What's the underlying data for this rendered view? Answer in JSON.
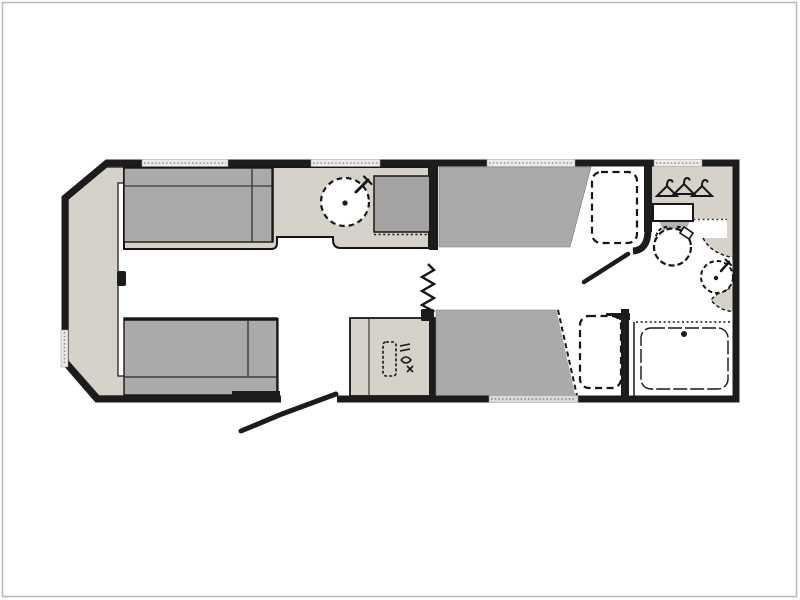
{
  "image": {
    "kind": "floor-plan-drawing",
    "visible_text": ""
  },
  "colors": {
    "page_bg": "#ffffff",
    "border": "#b9b9b9",
    "wall": "#1c1c1c",
    "furniture_light": "#d6d2c9",
    "furniture_dark": "#acaaa8",
    "hob": "#a6a4a2",
    "cistern_neck": "#b5b3b0",
    "window_fill": "#eceae8",
    "window_tick": "#8f8f8f",
    "fixture_line": "#161616",
    "thin_line": "#3a3a3a"
  },
  "legend": {
    "plan": "caravan floor plan",
    "shell": "caravan outer wall",
    "front_chest": "front chest shelf",
    "offside_sofa": "lounge sofa top",
    "nearside_sofa": "lounge sofa bottom",
    "worktop": "kitchen worktop",
    "sink": "round kitchen sink with tap",
    "hob": "hob",
    "wardrobe": "wardrobe",
    "hangers": "clothes hanger icons",
    "toilet": "toilet with cistern",
    "basin": "corner wash basin with tap",
    "shower": "shower tray with drain",
    "offside_bed": "fixed single bed top",
    "nearside_bed": "fixed single bed bottom",
    "bunk_top": "overhead bunk outline top",
    "bunk_bottom": "overhead bunk outline bottom",
    "heater": "heater cabinet",
    "heater_icon": "heater icon",
    "entrance_door": "entrance door leaf",
    "washroom_door": "washroom door leaf",
    "concertina": "concertina divider door",
    "window": "window",
    "wheel_arch": "wheel arch step",
    "divider": "kitchen divider wall"
  }
}
